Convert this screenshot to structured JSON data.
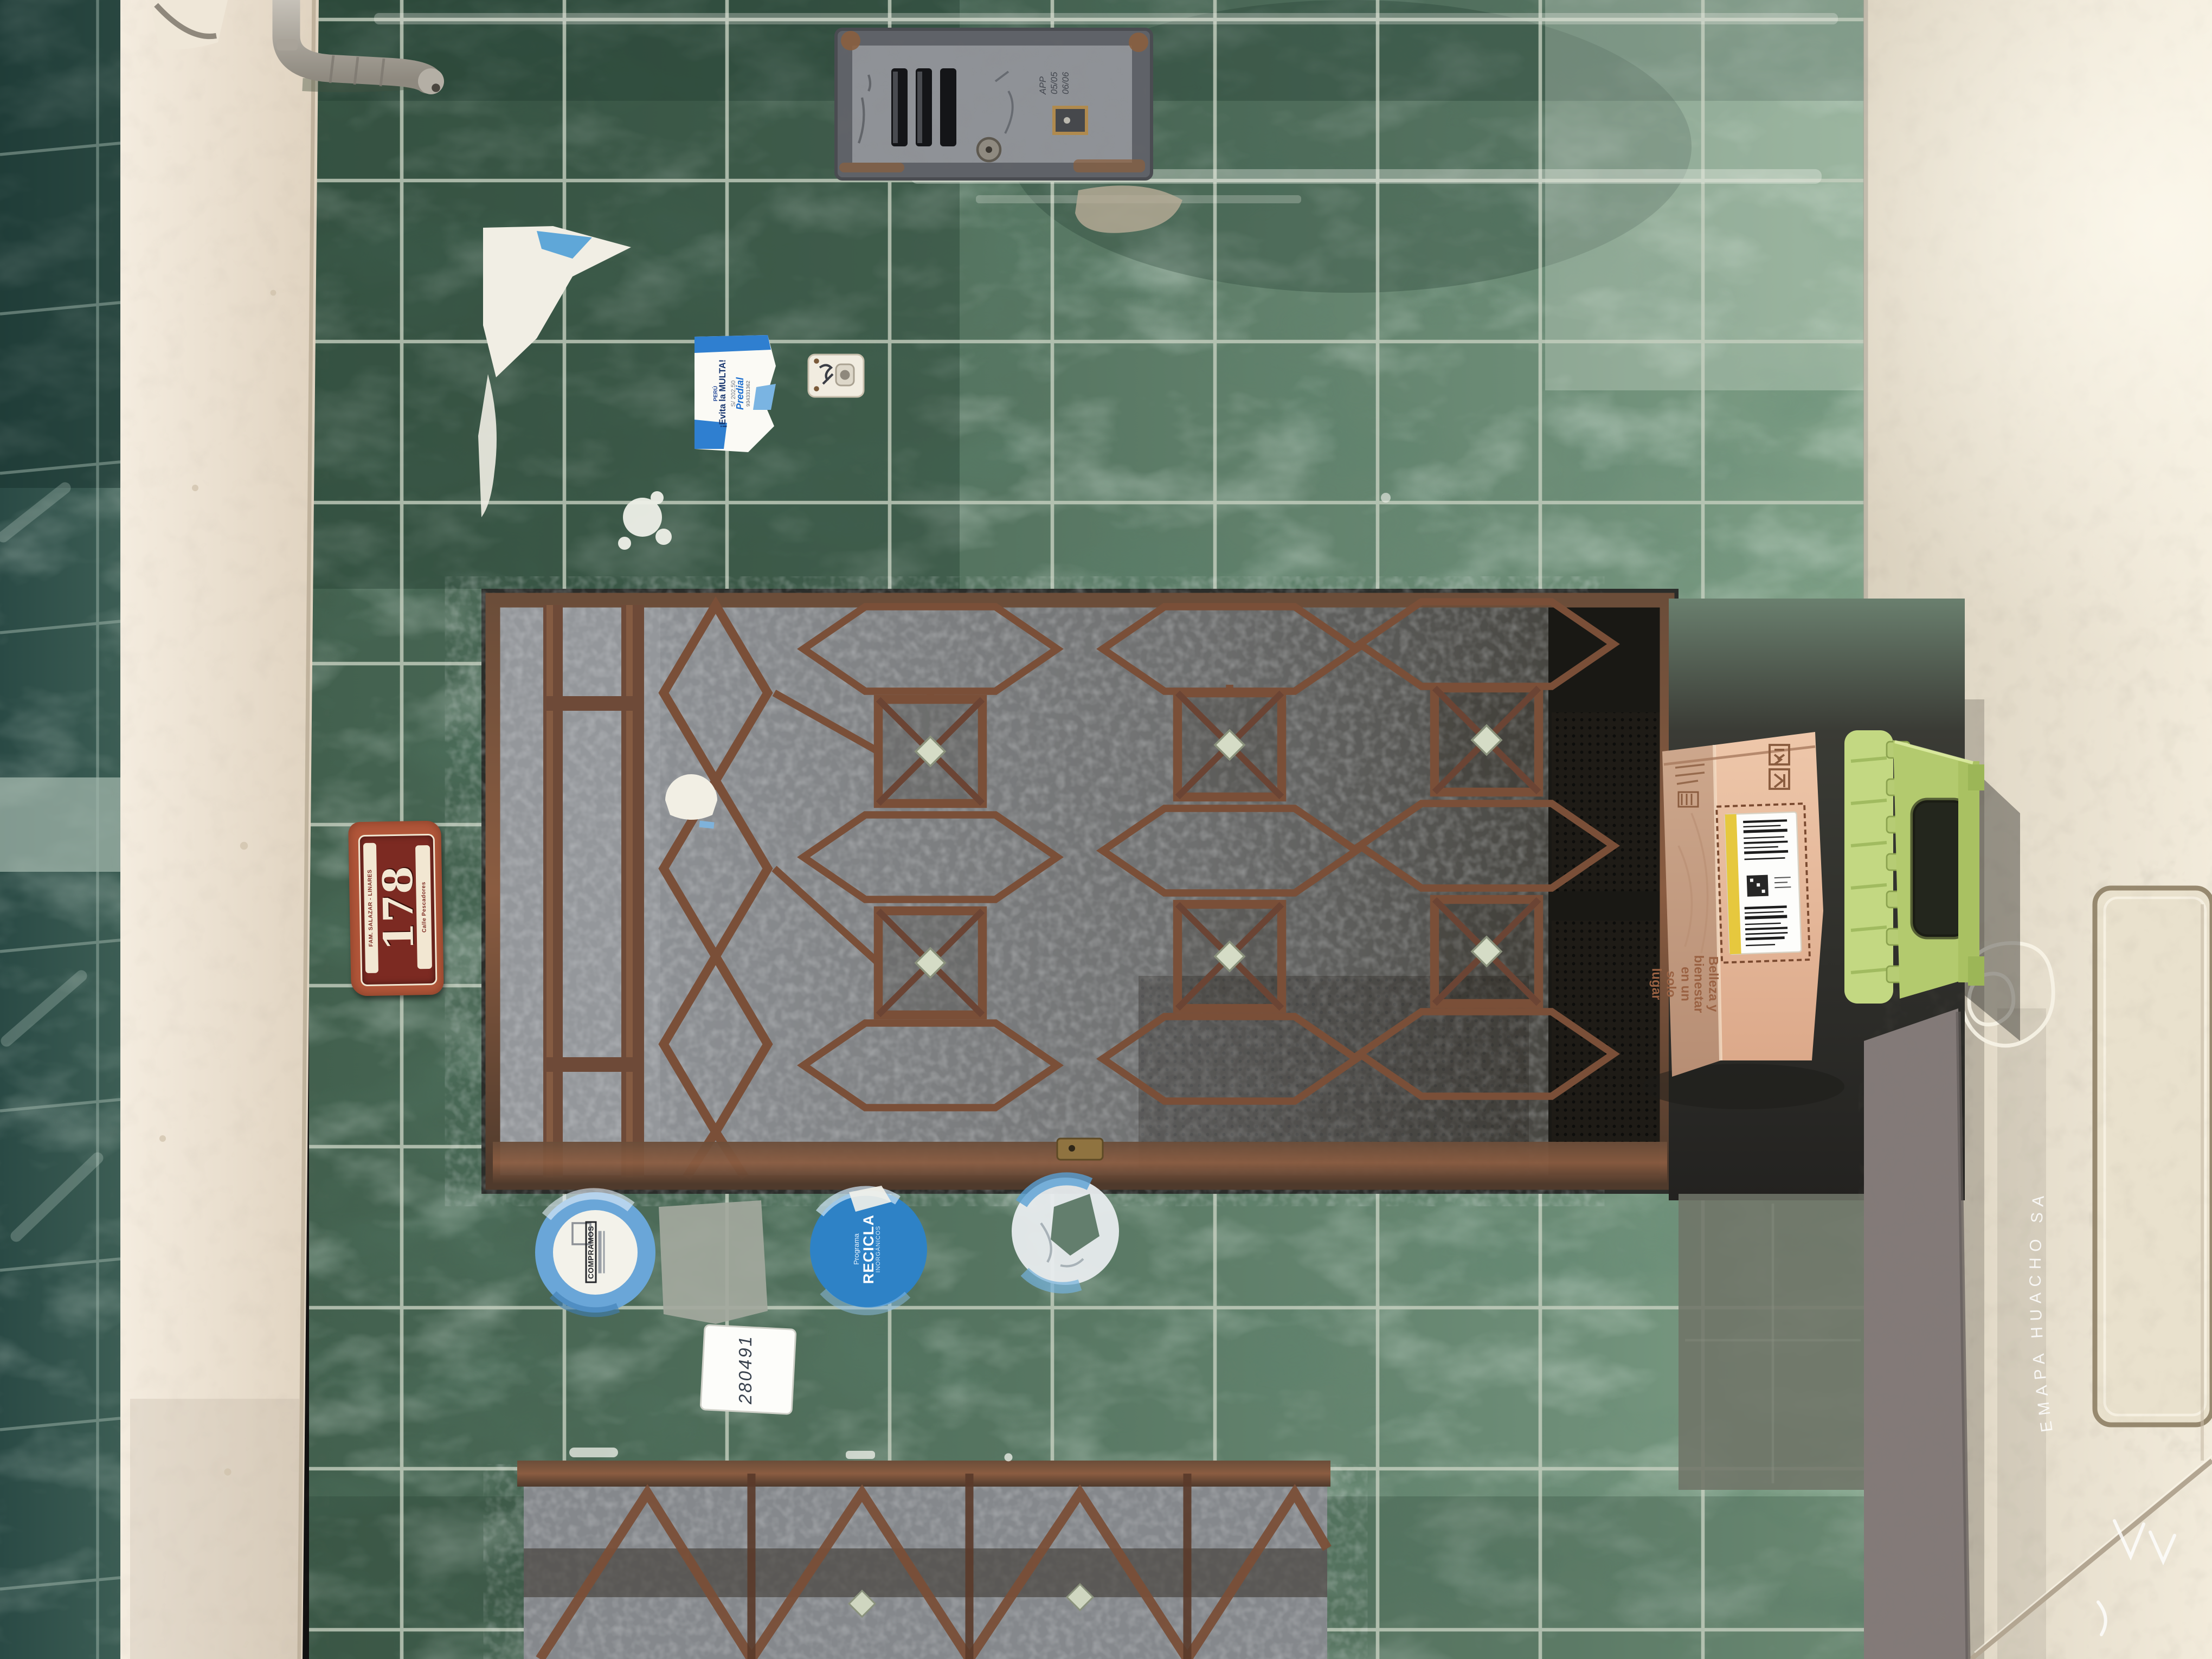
{
  "plaque": {
    "family": "FAM. SALAZAR - LINARES",
    "number": "178",
    "street": "Calle Pescadores"
  },
  "meter_box": {
    "handwriting": "APP 05/05 06/06"
  },
  "stickers": {
    "tax": {
      "country": "PERÚ",
      "headline": "¡Evita la MULTA!",
      "amount": "S/ 202.50",
      "service": "Predial",
      "phone": "934331362"
    },
    "compramos": {
      "label": "COMPRAMOS"
    },
    "recicla": {
      "program": "Programa",
      "title": "RECICLA",
      "subtitle": "INORGÁNICOS"
    },
    "number": {
      "value": "280491"
    }
  },
  "box": {
    "tagline": "Belleza y bienestar en un solo lugar",
    "icons": [
      "this-side-up-icon",
      "fragile-icon",
      "keep-dry-icon"
    ]
  },
  "floor": {
    "stamp": "EMAPA HUACHO SA"
  },
  "palette": {
    "tile_green": "#55725f",
    "tile_dark": "#34503f",
    "grout": "#c6d0c0",
    "teal_strip": "#2e4f4a",
    "wall_cream": "#f0e7d9",
    "rust": "#7a4f38",
    "glass_gray": "#8d9094",
    "alcove_dark": "#2c2b27",
    "cardboard": "#e3b494",
    "label_yellow": "#e6c83e",
    "stool_green": "#b5cc6a",
    "sidewalk_beige": "#e9e1cf",
    "plaque_red": "#7c2a22",
    "plaque_cream": "#f2e7d2",
    "sticker_blue": "#2f7fd0"
  }
}
